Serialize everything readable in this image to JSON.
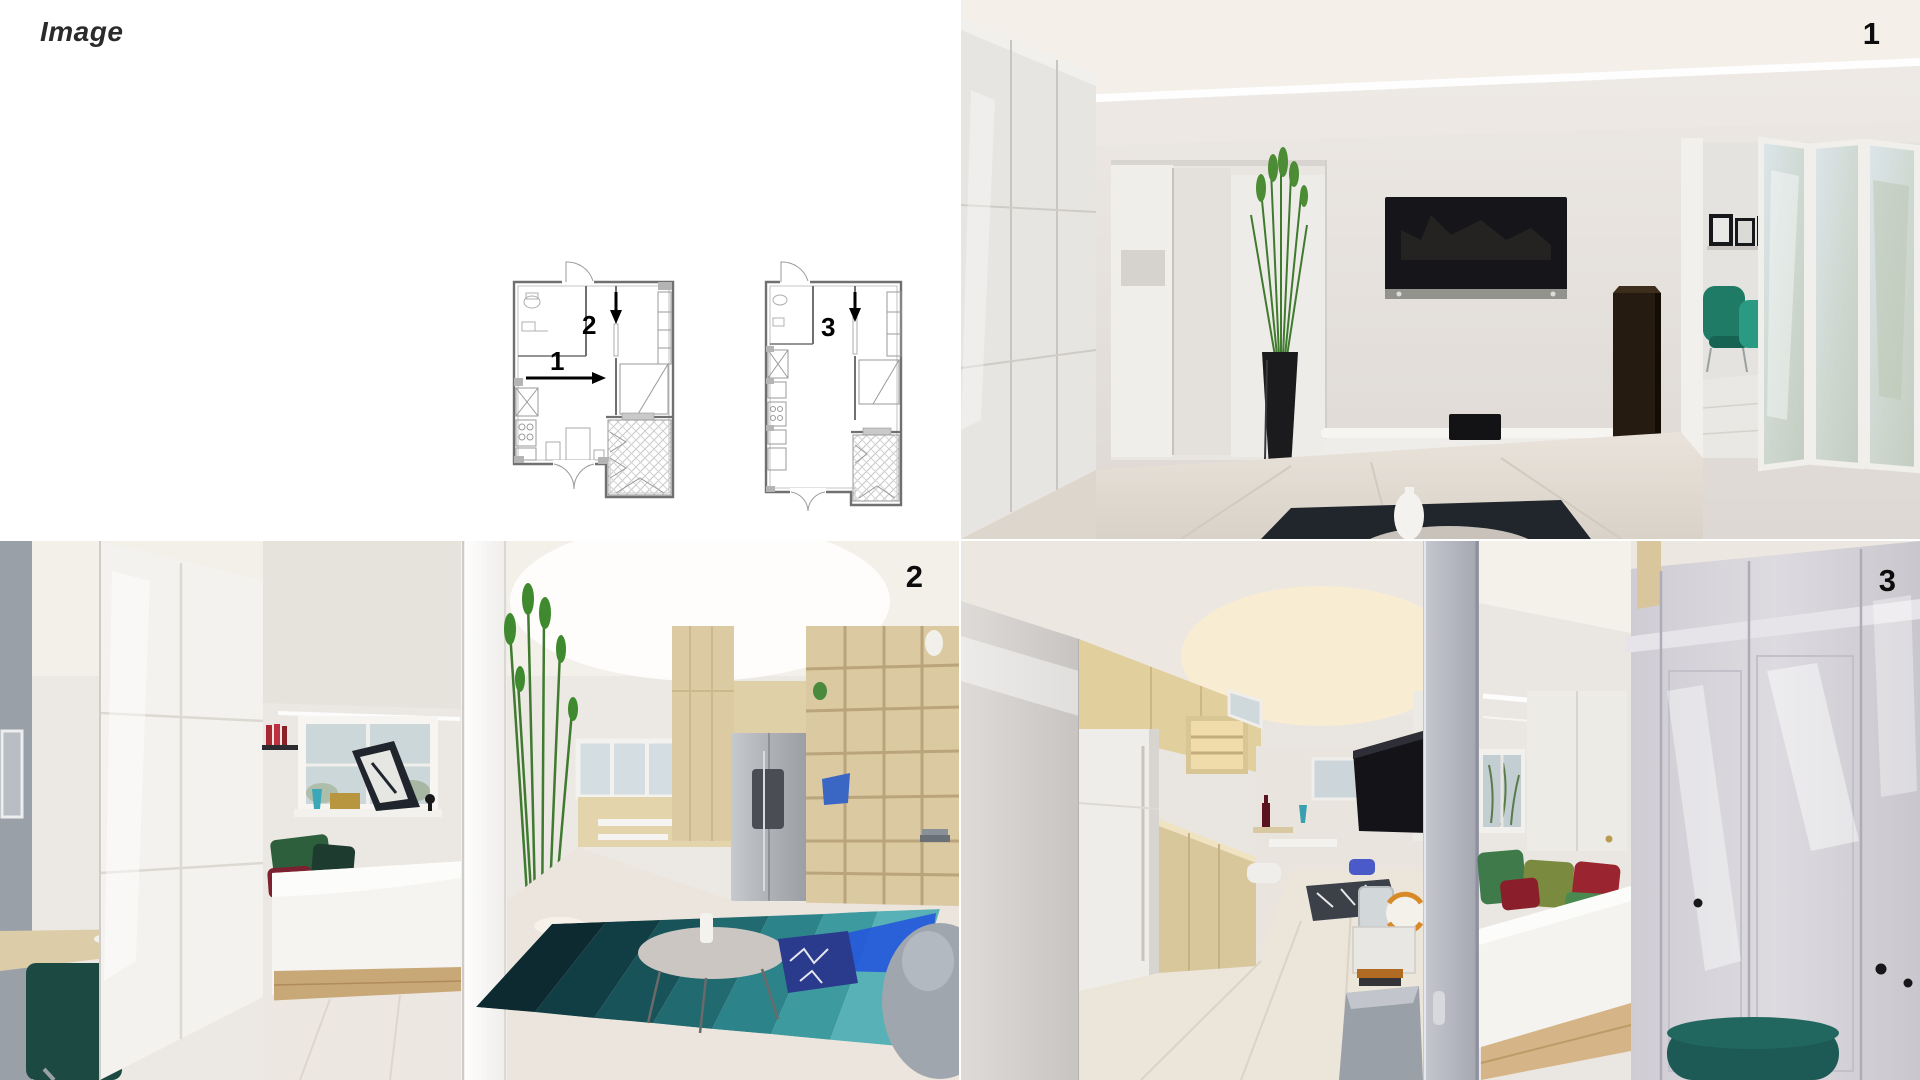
{
  "header": {
    "title": "Image"
  },
  "views": [
    {
      "label": "1",
      "description": "render of living room with wall TV, tall grass plant, white sideboard, speaker and folding glass doors to balcony"
    },
    {
      "label": "2",
      "description": "render of bedroom nook with wardrobe, bed with green and red pillows, tall plant, kitchen with fridge, wood shelving and blue striped rug"
    },
    {
      "label": "3",
      "description": "render of kitchen corridor with fridge and wood cabinets, bed with colorful pillows, gray wardrobe and teal chair"
    }
  ],
  "plans": [
    {
      "name": "floor-plan-a",
      "arrows": [
        {
          "label": "1",
          "direction": "right"
        },
        {
          "label": "2",
          "direction": "down"
        }
      ]
    },
    {
      "name": "floor-plan-b",
      "arrows": [
        {
          "label": "3",
          "direction": "down"
        }
      ]
    }
  ],
  "palette": {
    "plan_line": "#8a8a8a",
    "plan_wall": "#707070",
    "arrow_black": "#000000",
    "ceiling_beige": "#f0ebe4",
    "wall_white": "#e8e4e0",
    "floor_wood": "#e6e0d7",
    "tv_black": "#15151a",
    "plant_green": "#3f7a2e",
    "planter_black": "#1b1b1d",
    "speaker_brown": "#281d12",
    "chair_teal": "#1f7a66",
    "bed_white": "#f5f3f0",
    "bed_base_wood": "#c9a878",
    "pillow_green": "#2d5f3d",
    "pillow_maroon": "#7c2130",
    "rug_teal_dark": "#0d2a30",
    "rug_teal_light": "#58b1b6",
    "rug_blue": "#2353de",
    "shelf_wood": "#dbc9a2",
    "fridge_steel": "#b5b9bd",
    "wardrobe_gray": "#d4d2d6",
    "bench_darkwood": "#4a2e1e",
    "armchair_teal": "#1d5a55"
  }
}
